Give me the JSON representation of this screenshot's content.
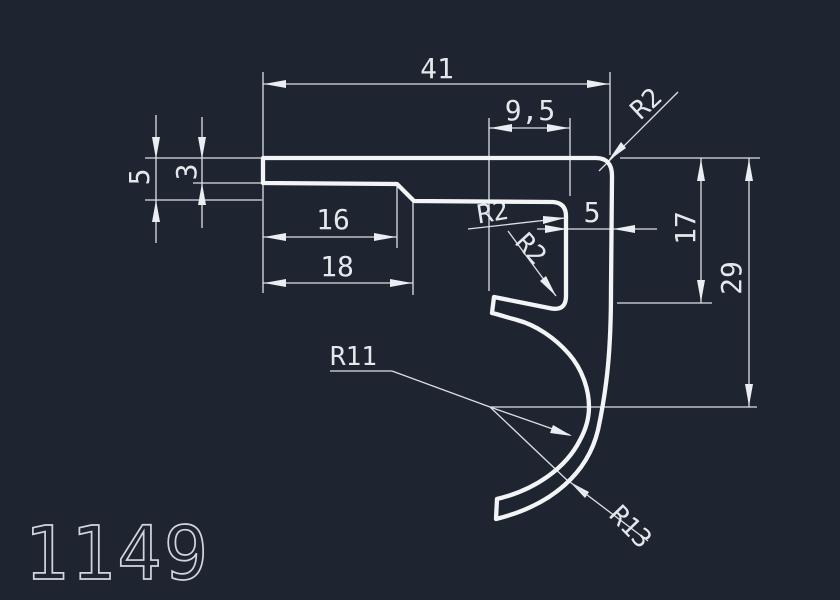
{
  "drawing": {
    "part_number": "1149",
    "dimensions": {
      "width_total": "41",
      "offset_9_5": "9,5",
      "height_5": "5",
      "thickness_3": "3",
      "length_16": "16",
      "length_18": "18",
      "wall_5": "5",
      "height_17": "17",
      "height_29": "29"
    },
    "radii": {
      "top_corner": "R2",
      "pocket_top": "R2",
      "pocket_bottom": "R2",
      "hook_inner": "R11",
      "hook_outer": "R13"
    },
    "colors": {
      "background": "#1f2530",
      "profile_line": "#f3f4f6",
      "dimension_line": "#dce0e6",
      "label_text": "#e4e7eb",
      "part_number_text": "#d2d6dc"
    }
  }
}
